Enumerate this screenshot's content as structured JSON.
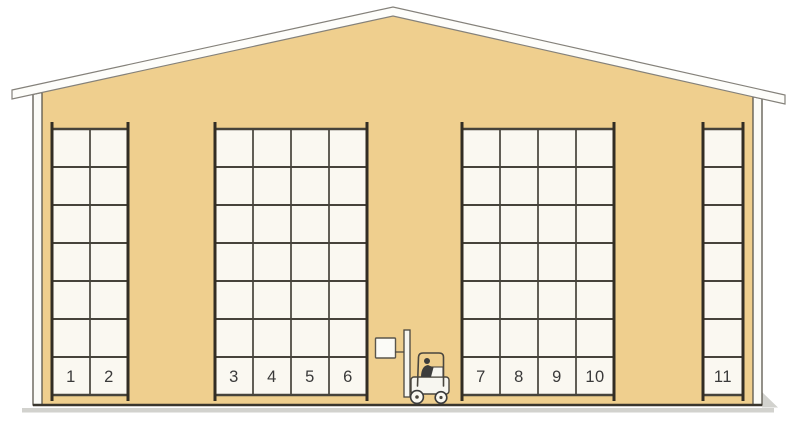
{
  "scene": {
    "colors": {
      "background": "#ffffff",
      "wall": "#efcf8e",
      "roof": "#fdfdfa",
      "roof_outline": "#84817a",
      "wall_strip": "#fbfbf7",
      "strip_outline": "#5a564c",
      "rack_fill": "#faf8f1",
      "grid_line": "#46433b",
      "post": "#322d24",
      "number": "#3a3a3a",
      "floor_line": "#3a362e",
      "shadow": "#d2d2ce",
      "forklift_outline": "#4a463e",
      "forklift_body": "#f7f6f0",
      "driver": "#3c3c3c"
    },
    "rack_geometry": {
      "top_line_y": 129,
      "bottom_line_y": 395,
      "post_top_y": 122,
      "post_bottom_y": 401,
      "rows": 7
    },
    "racks": [
      {
        "name": "rack-section-1",
        "x": 52,
        "cols": 2,
        "col_w": 38,
        "numbers": [
          "1",
          "2"
        ]
      },
      {
        "name": "rack-section-2",
        "x": 215,
        "cols": 4,
        "col_w": 38,
        "numbers": [
          "3",
          "4",
          "5",
          "6"
        ]
      },
      {
        "name": "rack-section-3",
        "x": 462,
        "cols": 4,
        "col_w": 38,
        "numbers": [
          "7",
          "8",
          "9",
          "10"
        ]
      },
      {
        "name": "rack-section-4",
        "x": 703,
        "cols": 1,
        "col_w": 40,
        "numbers": [
          "11"
        ]
      }
    ]
  }
}
